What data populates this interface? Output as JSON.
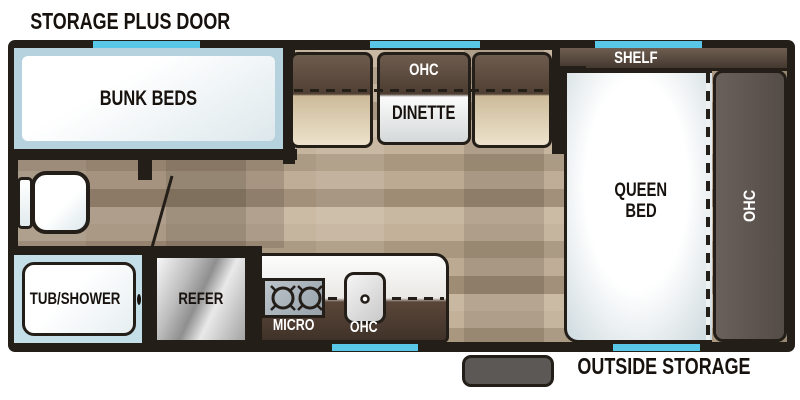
{
  "labels": {
    "storage_plus_door": "STORAGE PLUS DOOR",
    "outside_storage": "OUTSIDE STORAGE",
    "bunk_beds": "BUNK BEDS",
    "dinette_ohc": "OHC",
    "dinette": "DINETTE",
    "shelf": "SHELF",
    "queen_line1": "QUEEN",
    "queen_line2": "BED",
    "bedroom_ohc": "OHC",
    "tub_shower": "TUB/SHOWER",
    "refer": "REFER",
    "micro": "MICRO",
    "kitchen_ohc": "OHC"
  },
  "colors": {
    "wall": "#241e19",
    "window_accent": "#58c7e8",
    "cabinet_dark_brown": "#54463b",
    "bench_tan": "#e6d9bc",
    "bunk_trim_blue": "#b5d2de",
    "tub_trim_blue": "#c5dfe9",
    "floor_wood": "#b2a18b",
    "bedroom_panel_gray": "#5d5450",
    "step_gray": "#5b5856"
  }
}
